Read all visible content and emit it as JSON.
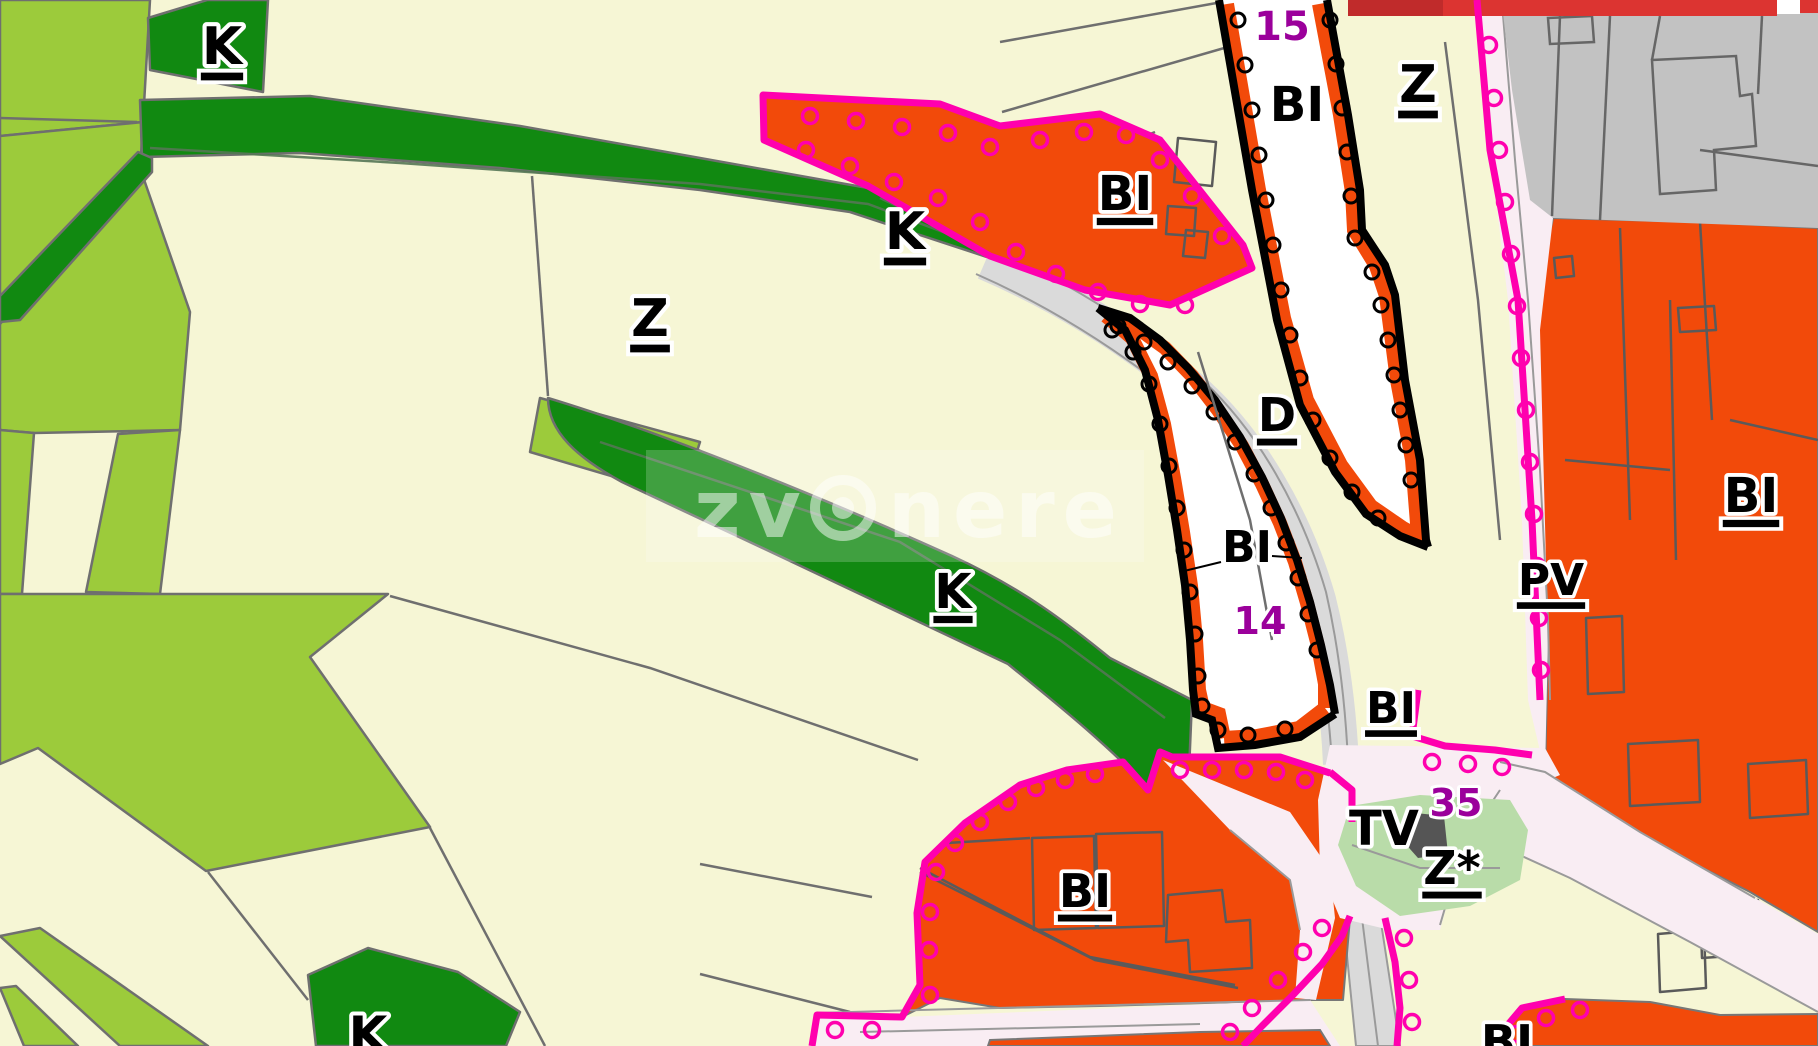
{
  "map": {
    "zone_codes_visible": [
      "K",
      "Z",
      "BI",
      "D",
      "PV",
      "TV",
      "Z*"
    ],
    "zone_numbers_visible": [
      "15",
      "14",
      "35"
    ],
    "colors": {
      "farmland_green": "#9CCB3B",
      "forest_dark_green": "#118911",
      "field_cream": "#F6F6D5",
      "residential_orange": "#F24A0A",
      "boundary_magenta": "#FF00AE",
      "road_gray": "#DADADA",
      "built_area_gray": "#C2C2C2",
      "road_pink": "#F9EDF3",
      "park_light_green": "#B9DCA9",
      "top_bar_red": "#DC3431",
      "zone_number_purple": "#9B009B",
      "label_black": "#000000",
      "label_halo_white": "#FFFFFF"
    },
    "watermark": {
      "prefix": "zv",
      "suffix": "nere"
    },
    "labels": [
      {
        "text": "K",
        "x": 222,
        "y": 64,
        "size": 52,
        "underline": true,
        "color": "#000000"
      },
      {
        "text": "K",
        "x": 905,
        "y": 249,
        "size": 52,
        "underline": true,
        "color": "#000000"
      },
      {
        "text": "Z",
        "x": 650,
        "y": 336,
        "size": 52,
        "underline": true,
        "color": "#000000"
      },
      {
        "text": "K",
        "x": 953,
        "y": 608,
        "size": 48,
        "underline": true,
        "color": "#000000"
      },
      {
        "text": "K",
        "x": 368,
        "y": 1052,
        "size": 50,
        "underline": true,
        "color": "#000000"
      },
      {
        "text": "BI",
        "x": 1125,
        "y": 210,
        "size": 48,
        "underline": true,
        "color": "#000000"
      },
      {
        "text": "BI",
        "x": 1297,
        "y": 121,
        "size": 48,
        "underline": false,
        "color": "#000000"
      },
      {
        "text": "Z",
        "x": 1418,
        "y": 102,
        "size": 52,
        "underline": true,
        "color": "#000000"
      },
      {
        "text": "15",
        "x": 1282,
        "y": 40,
        "size": 40,
        "underline": false,
        "color": "#9B009B"
      },
      {
        "text": "D",
        "x": 1277,
        "y": 431,
        "size": 46,
        "underline": true,
        "color": "#000000"
      },
      {
        "text": "BI",
        "x": 1247,
        "y": 562,
        "size": 44,
        "underline": false,
        "color": "#000000"
      },
      {
        "text": "14",
        "x": 1260,
        "y": 634,
        "size": 38,
        "underline": false,
        "color": "#9B009B"
      },
      {
        "text": "PV",
        "x": 1551,
        "y": 595,
        "size": 44,
        "underline": true,
        "color": "#000000"
      },
      {
        "text": "BI",
        "x": 1751,
        "y": 512,
        "size": 48,
        "underline": true,
        "color": "#000000"
      },
      {
        "text": "BI",
        "x": 1391,
        "y": 723,
        "size": 44,
        "underline": true,
        "color": "#000000"
      },
      {
        "text": "TV",
        "x": 1384,
        "y": 845,
        "size": 48,
        "underline": false,
        "color": "#000000"
      },
      {
        "text": "35",
        "x": 1456,
        "y": 816,
        "size": 38,
        "underline": false,
        "color": "#9B009B"
      },
      {
        "text": "Z*",
        "x": 1452,
        "y": 884,
        "size": 46,
        "underline": true,
        "color": "#000000"
      },
      {
        "text": "BI",
        "x": 1085,
        "y": 907,
        "size": 46,
        "underline": true,
        "color": "#000000"
      },
      {
        "text": "BI",
        "x": 1507,
        "y": 1058,
        "size": 46,
        "underline": true,
        "color": "#000000"
      }
    ]
  }
}
